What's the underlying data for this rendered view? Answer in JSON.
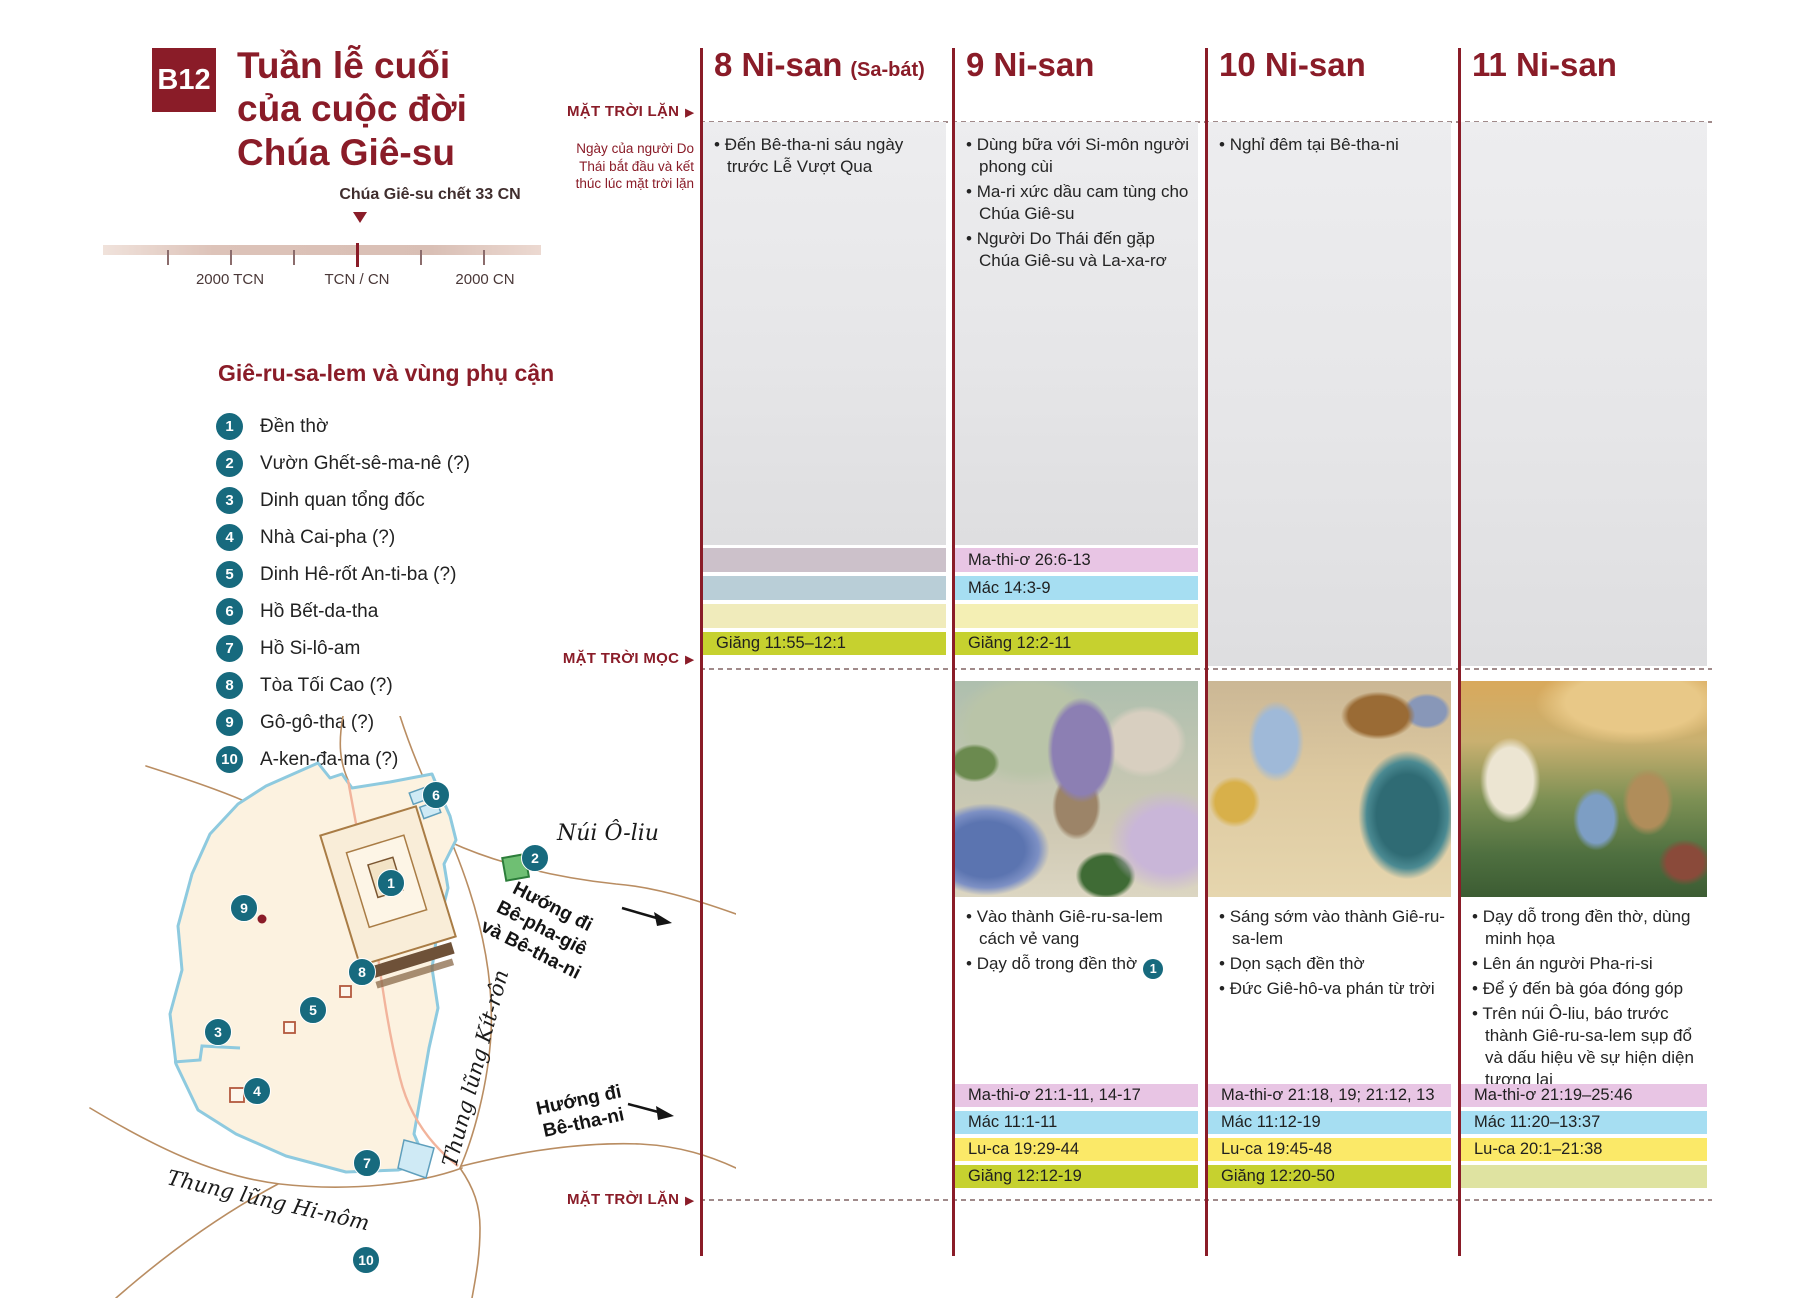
{
  "page": {
    "badge": "B12",
    "title_lines": [
      "Tuần lễ cuối",
      "của cuộc đời",
      "Chúa Giê-su"
    ]
  },
  "timeline": {
    "marker_label": "Chúa Giê-su chết 33 CN",
    "ticks": [
      "2000 TCN",
      "TCN / CN",
      "2000 CN"
    ]
  },
  "legend": {
    "heading": "Giê-ru-sa-lem và vùng phụ cận",
    "items": [
      {
        "num": "1",
        "label": "Đền thờ"
      },
      {
        "num": "2",
        "label": "Vườn Ghết-sê-ma-nê (?)"
      },
      {
        "num": "3",
        "label": "Dinh quan tổng đốc"
      },
      {
        "num": "4",
        "label": "Nhà Cai-pha (?)"
      },
      {
        "num": "5",
        "label": "Dinh Hê-rốt An-ti-ba (?)"
      },
      {
        "num": "6",
        "label": "Hồ Bết-da-tha"
      },
      {
        "num": "7",
        "label": "Hồ Si-lô-am"
      },
      {
        "num": "8",
        "label": "Tòa Tối Cao (?)"
      },
      {
        "num": "9",
        "label": "Gô-gô-tha (?)"
      },
      {
        "num": "10",
        "label": "A-ken-đa-ma (?)"
      }
    ]
  },
  "map": {
    "labels": {
      "mount": "Núi Ô-liu",
      "kidron": "Thung lũng Kít-rôn",
      "hinnom": "Thung lũng Hi-nôm"
    },
    "road_bethphage_lines": [
      "Hướng đi",
      "Bê-pha-giê",
      "và Bê-tha-ni"
    ],
    "road_bethany_lines": [
      "Hướng đi",
      "Bê-tha-ni"
    ],
    "markers": [
      "1",
      "2",
      "3",
      "4",
      "5",
      "6",
      "7",
      "8",
      "9",
      "10"
    ]
  },
  "gutter": {
    "sunset_top": "MẶT TRỜI LẶN",
    "day_note": "Ngày của người Do Thái bắt đầu và kết thúc lúc mặt trời lặn",
    "sunrise": "MẶT TRỜI MỌC",
    "sunset_bottom": "MẶT TRỜI LẶN"
  },
  "columns": [
    {
      "header": "8 Ni-san",
      "header_suffix": "(Sa-bát)",
      "night_events": [
        "Đến Bê-tha-ni sáu ngày trước Lễ Vượt Qua"
      ],
      "refs_top": {
        "john": "Giăng 11:55–12:1"
      }
    },
    {
      "header": "9 Ni-san",
      "header_suffix": "",
      "night_events": [
        "Dùng bữa với Si-môn người phong cùi",
        "Ma-ri xức dầu cam tùng cho Chúa Giê-su",
        "Người Do Thái đến gặp Chúa Giê-su và La-xa-rơ"
      ],
      "refs_top": {
        "matthew": "Ma-thi-ơ 26:6-13",
        "mark": "Mác 14:3-9",
        "john": "Giăng 12:2-11"
      },
      "image": "Chúa Giê-su vào thành Giê-ru-sa-lem cách vẻ vang",
      "day_events": [
        "Vào thành Giê-ru-sa-lem cách vẻ vang",
        "Dạy dỗ trong đền thờ"
      ],
      "day_badge": "1",
      "refs_bottom": {
        "matthew": "Ma-thi-ơ 21:1-11, 14-17",
        "mark": "Mác 11:1-11",
        "luke": "Lu-ca 19:29-44",
        "john": "Giăng 12:12-19"
      }
    },
    {
      "header": "10 Ni-san",
      "header_suffix": "",
      "night_events": [
        "Nghỉ đêm tại Bê-tha-ni"
      ],
      "image": "Chúa Giê-su dọn sạch đền thờ",
      "day_events": [
        "Sáng sớm vào thành Giê-ru-sa-lem",
        "Dọn sạch đền thờ",
        "Đức Giê-hô-va phán từ trời"
      ],
      "refs_bottom": {
        "matthew": "Ma-thi-ơ 21:18, 19; 21:12, 13",
        "mark": "Mác 11:12-19",
        "luke": "Lu-ca 19:45-48",
        "john": "Giăng 12:20-50"
      }
    },
    {
      "header": "11 Ni-san",
      "header_suffix": "",
      "night_events": [],
      "image": "Chúa Giê-su dạy dỗ trên núi Ô-liu",
      "day_events": [
        "Dạy dỗ trong đền thờ, dùng minh họa",
        "Lên án người Pha-ri-si",
        "Để ý đến bà góa đóng góp",
        "Trên núi Ô-liu, báo trước thành Giê-ru-sa-lem sụp đổ và dấu hiệu về sự hiện diện tương lai"
      ],
      "refs_bottom": {
        "matthew": "Ma-thi-ơ 21:19–25:46",
        "mark": "Mác 11:20–13:37",
        "luke": "Lu-ca 20:1–21:38"
      }
    }
  ],
  "colors": {
    "accent_maroon": "#8a1c28",
    "marker_teal": "#176a7e",
    "band_matthew": "#e8c5e4",
    "band_mark": "#a6def2",
    "band_luke": "#fbe968",
    "band_john": "#c6d12f"
  }
}
